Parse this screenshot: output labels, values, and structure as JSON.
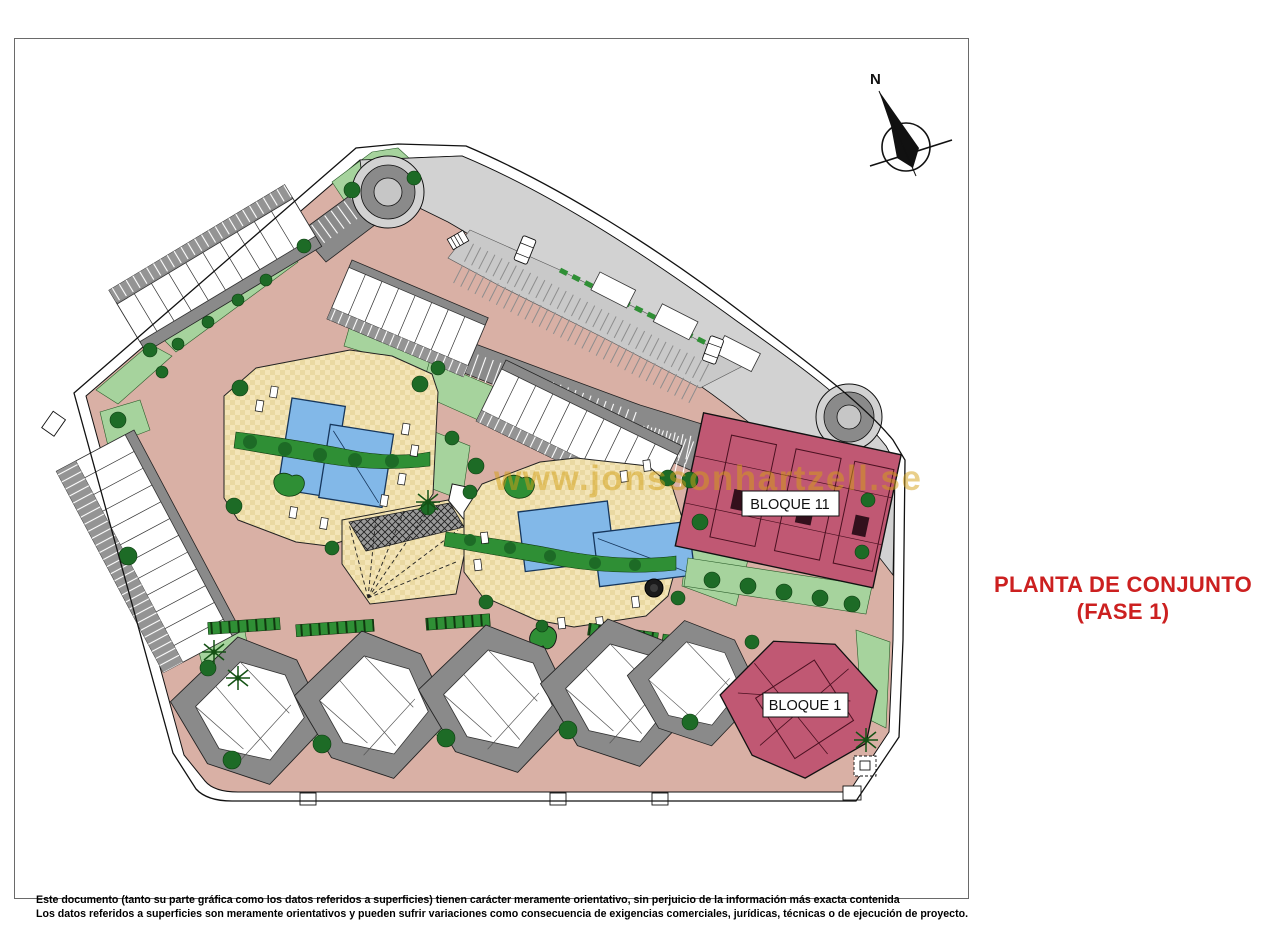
{
  "page": {
    "title_line1": "PLANTA DE CONJUNTO",
    "title_line2": "(FASE 1)",
    "watermark": "www.jonssonhartzell.se",
    "compass_label": "N",
    "disclaimer_line1": "Este documento (tanto su parte gráfica como los datos referidos a superficies) tienen carácter meramente orientativo, sin perjuicio de la información más exacta contenida",
    "disclaimer_line2": "Los datos referidos a superficies son meramente orientativos y pueden sufrir variaciones como consecuencia de exigencias comerciales, jurídicas, técnicas o de ejecución de proyecto."
  },
  "plan": {
    "labels": {
      "bloque11": "BLOQUE 11",
      "bloque1": "BLOQUE 1"
    }
  },
  "colors": {
    "title_red": "#cc2020",
    "bloque_pink": "#c05873",
    "pool_blue": "#82b8e8",
    "road_salmon": "#d9b0a5",
    "lawn_green": "#a6d39d",
    "tree_green": "#1d6b26",
    "hedge_green": "#2f8f35",
    "paving_yellow": "#f4e5b8",
    "parking_gray": "#8a8a8a",
    "roadband_gray": "#d2d2d2",
    "watermark_gold": "#d4a017"
  }
}
